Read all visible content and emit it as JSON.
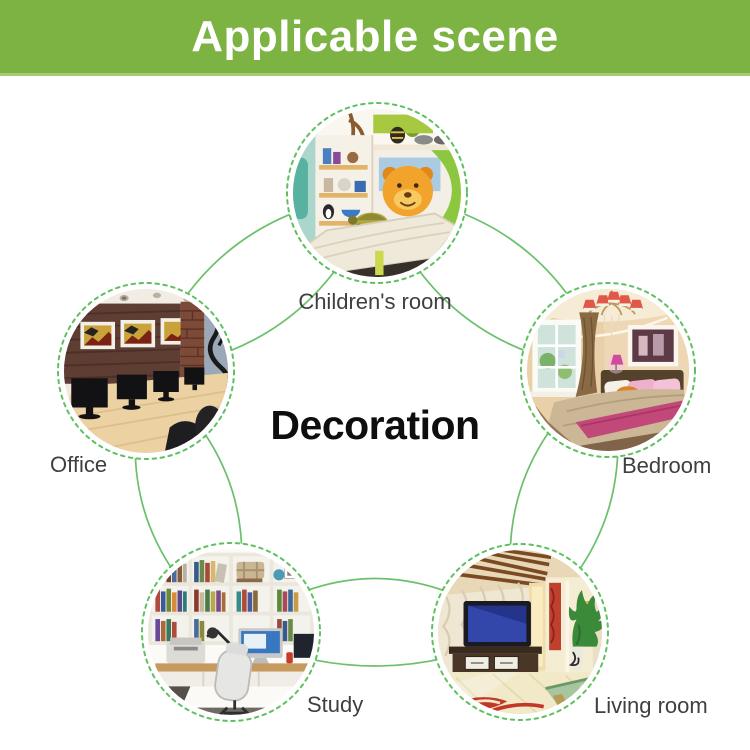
{
  "banner": {
    "title": "Applicable scene",
    "bg_color": "#7cb342",
    "text_color": "#ffffff"
  },
  "center_label": "Decoration",
  "diagram": {
    "connector_color": "#6cc06c",
    "circle_dash_color": "#5fc05f",
    "label_color": "#3f3f3f",
    "nodes": [
      {
        "id": "children-room",
        "label": "Children's room",
        "icon": "children-room-photo"
      },
      {
        "id": "office",
        "label": "Office",
        "icon": "office-photo"
      },
      {
        "id": "bedroom",
        "label": "Bedroom",
        "icon": "bedroom-photo"
      },
      {
        "id": "study",
        "label": "Study",
        "icon": "study-photo"
      },
      {
        "id": "living-room",
        "label": "Living room",
        "icon": "living-room-photo"
      }
    ]
  }
}
